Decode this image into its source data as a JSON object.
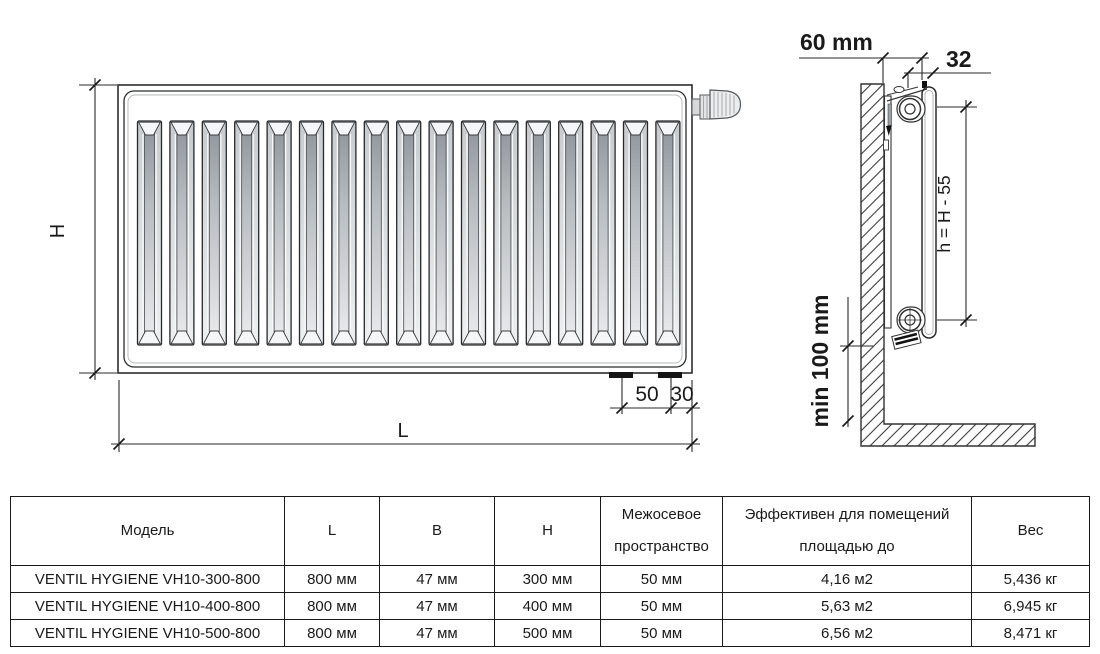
{
  "drawing": {
    "front_view": {
      "height_label": "H",
      "length_label": "L",
      "offset_50": "50",
      "offset_30": "30",
      "groove_count": 17
    },
    "side_view": {
      "wall_clearance": "60 mm",
      "bracket_depth": "32",
      "mount_height": "h = H - 55",
      "floor_clearance": "min 100 mm"
    }
  },
  "table": {
    "headers": [
      "Модель",
      "L",
      "B",
      "H",
      "Межосевое пространство",
      "Эффективен для помещений площадью до",
      "Вес"
    ],
    "rows": [
      [
        "VENTIL HYGIENE VH10-300-800",
        "800 мм",
        "47 мм",
        "300 мм",
        "50 мм",
        "4,16 м2",
        "5,436 кг"
      ],
      [
        "VENTIL HYGIENE VH10-400-800",
        "800 мм",
        "47 мм",
        "400 мм",
        "50 мм",
        "5,63 м2",
        "6,945 кг"
      ],
      [
        "VENTIL HYGIENE VH10-500-800",
        "800 мм",
        "47 мм",
        "500 мм",
        "50 мм",
        "6,56 м2",
        "8,471 кг"
      ]
    ]
  },
  "colors": {
    "line": "#2b2d2f",
    "text": "#1a1a1a"
  }
}
